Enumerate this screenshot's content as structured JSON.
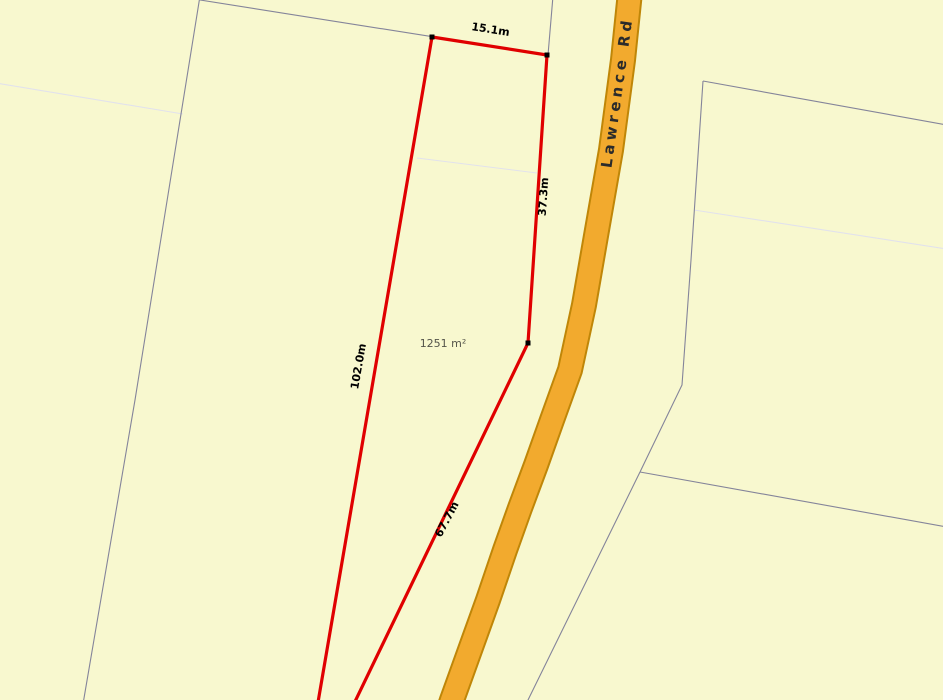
{
  "map": {
    "type": "cadastral-parcel-map",
    "road": {
      "name": "Lawrence Rd"
    },
    "selected_parcel": {
      "area_label": "1251 m²",
      "edge_dimensions": [
        {
          "edge": "top",
          "label": "15.1m"
        },
        {
          "edge": "right",
          "label": "37.3m"
        },
        {
          "edge": "left",
          "label": "102.0m"
        },
        {
          "edge": "lower-right",
          "label": "67.7m"
        }
      ]
    },
    "colors": {
      "background": "#F8F8CF",
      "road_fill": "#F2AA2E",
      "road_casing": "#BF8608",
      "parcel_boundary": "#84849A",
      "faint_boundary": "#E2E2EC",
      "selection_outline": "#E00000",
      "vertex_marker": "#000000",
      "dimension_text": "#000000",
      "area_text": "#54544A",
      "road_text": "#2B2B2B"
    }
  }
}
